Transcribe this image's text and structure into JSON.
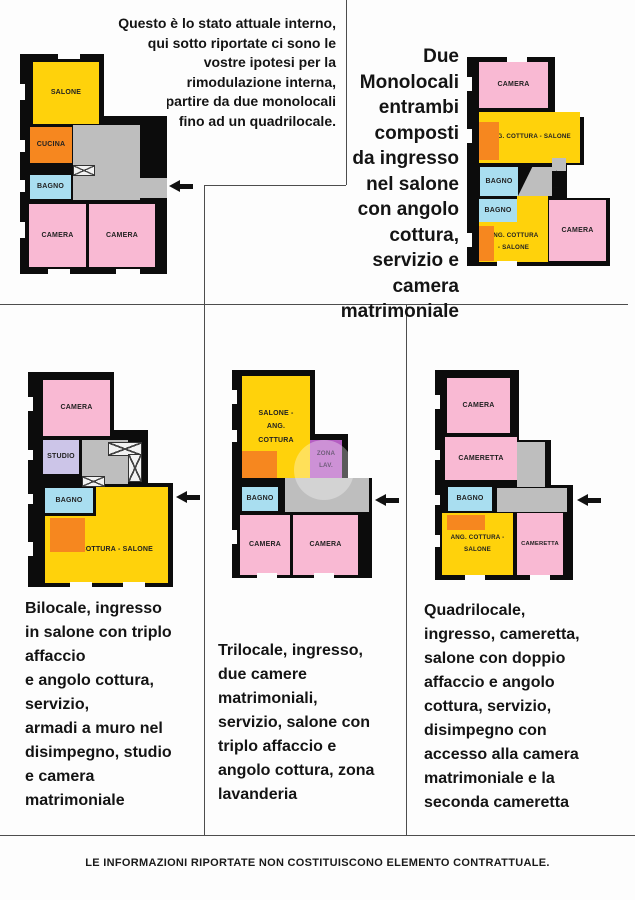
{
  "page": {
    "background": "#fdfdfd",
    "divider_color": "#4d4d4d",
    "footer": "LE INFORMAZIONI RIPORTATE NON COSTITUISCONO ELEMENTO CONTRATTUALE."
  },
  "colors": {
    "wall": "#0c0c0c",
    "salone_yellow": "#ffd20b",
    "cucina_orange": "#f6871f",
    "bagno_blue": "#a9def0",
    "camera_pink": "#f9b9d3",
    "hall_gray": "#bebebe",
    "studio_lavender": "#ccc5e8",
    "lavanderia_purple": "#b55ec3"
  },
  "texts": {
    "intro": "Questo è lo stato attuale interno,\nqui sotto riportate ci sono le\nvostre ipotesi per la\nrimodulazione interna,\na partire da due monolocali\nfino ad un quadrilocale.",
    "monolocali_title": "Due\nMonolocali\nentrambi\ncomposti\nda ingresso\nnel salone\ncon angolo cottura,\nservizio e\ncamera matrimoniale",
    "bilocale": "Bilocale, ingresso\nin salone con triplo\naffaccio\ne angolo cottura,\nservizio,\narmadi a muro nel\ndisimpegno, studio\ne camera\nmatrimoniale",
    "trilocale": "Trilocale, ingresso,\ndue camere\nmatrimoniali,\nservizio, salone con\ntriplo affaccio e\nangolo cottura, zona\nlavanderia",
    "quadrilocale": "Quadrilocale,\ningresso, cameretta,\nsalone con doppio\naffaccio e angolo\ncottura, servizio,\ndisimpegno con\naccesso alla camera\nmatrimoniale e la\nseconda cameretta"
  },
  "plans": {
    "current": {
      "salone": "SALONE",
      "cucina": "CUCINA",
      "bagno": "BAGNO",
      "camera1": "CAMERA",
      "camera2": "CAMERA"
    },
    "monolocali": {
      "camera1": "CAMERA",
      "cottura1": "ANG. COTTURA - SALONE",
      "bagno1": "BAGNO",
      "bagno2": "BAGNO",
      "cottura2": "ANG. COTTURA\n- SALONE",
      "camera2": "CAMERA",
      "arrow_up": "↑",
      "arrow_left": "←"
    },
    "bilocale": {
      "camera": "CAMERA",
      "studio": "STUDIO",
      "bagno": "BAGNO",
      "cottura": "ANG. COTTURA - SALONE"
    },
    "trilocale": {
      "salone": "SALONE -\nANG.\nCOTTURA",
      "zona": "ZONA\nLAV.",
      "bagno": "BAGNO",
      "camera1": "CAMERA",
      "camera2": "CAMERA"
    },
    "quadrilocale": {
      "camera": "CAMERA",
      "cameretta1": "CAMERETTA",
      "bagno": "BAGNO",
      "cottura": "ANG. COTTURA -\nSALONE",
      "cameretta2": "CAMERETTA"
    }
  }
}
